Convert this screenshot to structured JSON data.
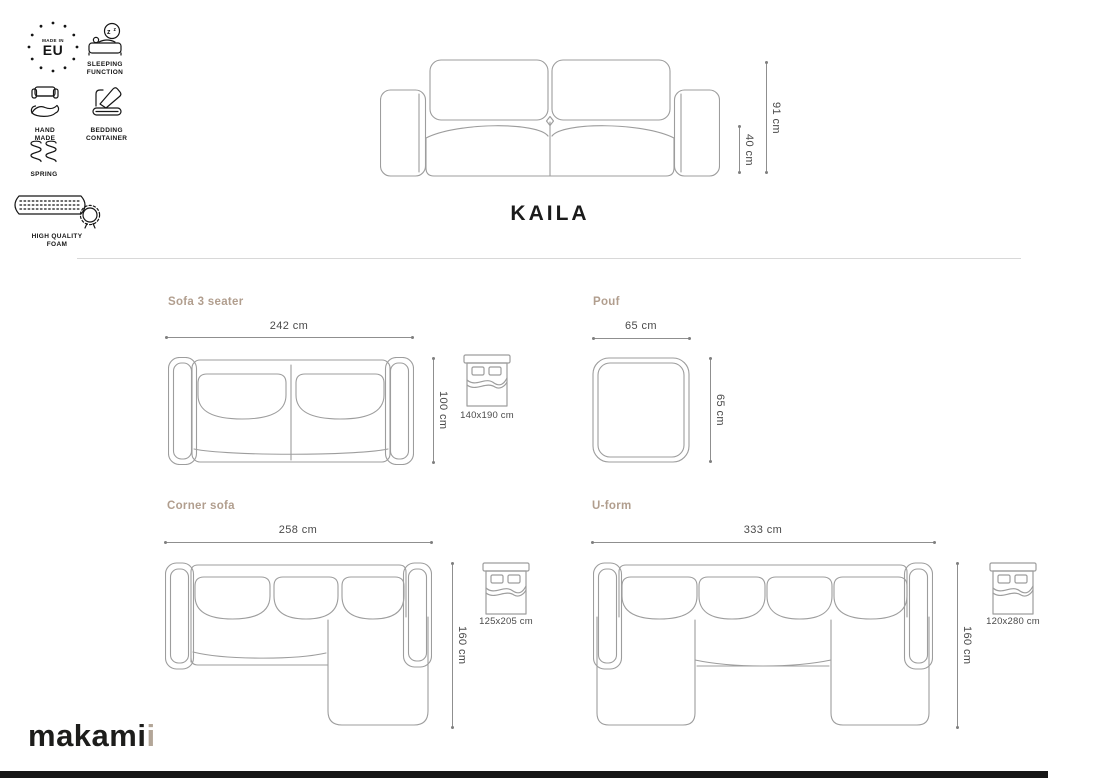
{
  "title": "KAILA",
  "brand": {
    "main": "makami",
    "accent": "i"
  },
  "badges": {
    "made_in_eu": {
      "top": "MADE IN",
      "main": "EU"
    },
    "sleeping_function": {
      "line1": "SLEEPING",
      "line2": "FUNCTION"
    },
    "hand_made": {
      "line1": "HAND",
      "line2": "MADE"
    },
    "bedding_container": {
      "line1": "BEDDING",
      "line2": "CONTAINER"
    },
    "spring": {
      "line1": "SPRING"
    },
    "high_quality_foam": {
      "line1": "HIGH QUALITY",
      "line2": "FOAM"
    }
  },
  "front_view": {
    "height": "91 cm",
    "seat_height": "40 cm"
  },
  "variants": {
    "sofa3": {
      "label": "Sofa 3 seater",
      "width": "242 cm",
      "depth": "100 cm",
      "sleeping_area": "140x190 cm"
    },
    "pouf": {
      "label": "Pouf",
      "width": "65 cm",
      "depth": "65 cm"
    },
    "corner": {
      "label": "Corner sofa",
      "width": "258 cm",
      "depth": "160 cm",
      "sleeping_area": "125x205 cm"
    },
    "uform": {
      "label": "U-form",
      "width": "333 cm",
      "depth": "160 cm",
      "sleeping_area": "120x280 cm"
    }
  },
  "colors": {
    "accent": "#b19e8e",
    "line_art": "#9d9d9d",
    "dimension": "#8f8f8f",
    "text": "#4a4a4a",
    "icon": "#161616"
  }
}
